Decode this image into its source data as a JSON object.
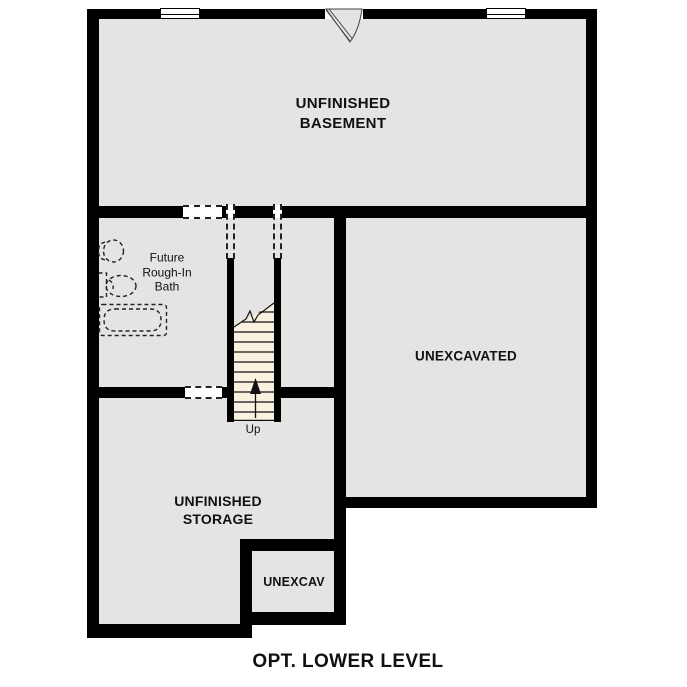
{
  "title": "OPT. LOWER LEVEL",
  "rooms": {
    "basement": {
      "name_lines": [
        "UNFINISHED",
        "BASEMENT"
      ]
    },
    "unexcavated": {
      "name": "UNEXCAVATED"
    },
    "bath": {
      "name_lines": [
        "Future",
        "Rough-In",
        "Bath"
      ]
    },
    "storage": {
      "name_lines": [
        "UNFINISHED",
        "STORAGE"
      ]
    },
    "unexcav_small": {
      "name": "UNEXCAV"
    }
  },
  "stairs": {
    "direction_label": "Up"
  },
  "symbols": {
    "window": "double-hung window symbol",
    "door_swing": "exterior door with swing arc",
    "toilet": "dashed future toilet rough-in",
    "sink": "dashed future sink rough-in",
    "bathtub": "dashed future bathtub rough-in",
    "up_arrow": "stair direction arrow",
    "break_line": "stair break line"
  },
  "colors": {
    "wall": "#000000",
    "floor": "#e5e4e2",
    "stair_tread": "#f9f2e1",
    "background": "#ffffff",
    "text": "#111111",
    "fixture_outline": "#222222"
  }
}
